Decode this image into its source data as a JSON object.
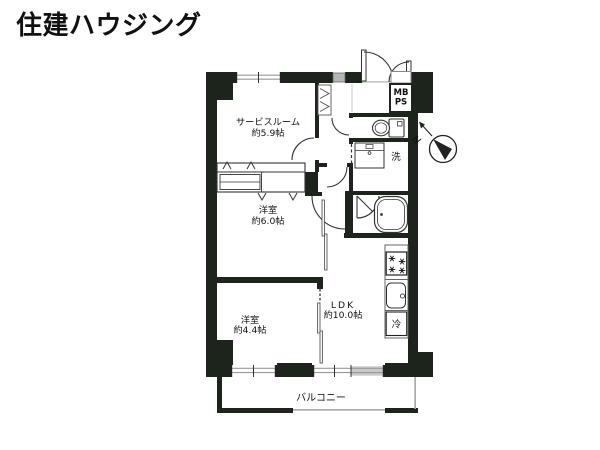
{
  "logo": {
    "text": "住建ハウジング",
    "color": "#aec5f1"
  },
  "floorplan": {
    "rooms": {
      "service_room": {
        "name": "サービスルーム",
        "size": "約5.9帖"
      },
      "western_room_6": {
        "name": "洋室",
        "size": "約6.0帖"
      },
      "western_room_4": {
        "name": "洋室",
        "size": "約4.4帖"
      },
      "ldk": {
        "name": "LDK",
        "size": "約10.0帖"
      },
      "balcony": {
        "name": "バルコニー"
      }
    },
    "labels": {
      "meter_box": "MB",
      "pipe_space": "PS",
      "washing_machine": "洗",
      "refrigerator": "冷",
      "compass_north": "N"
    },
    "colors": {
      "wall": "#1c241c",
      "window_frame": "#999999"
    }
  }
}
